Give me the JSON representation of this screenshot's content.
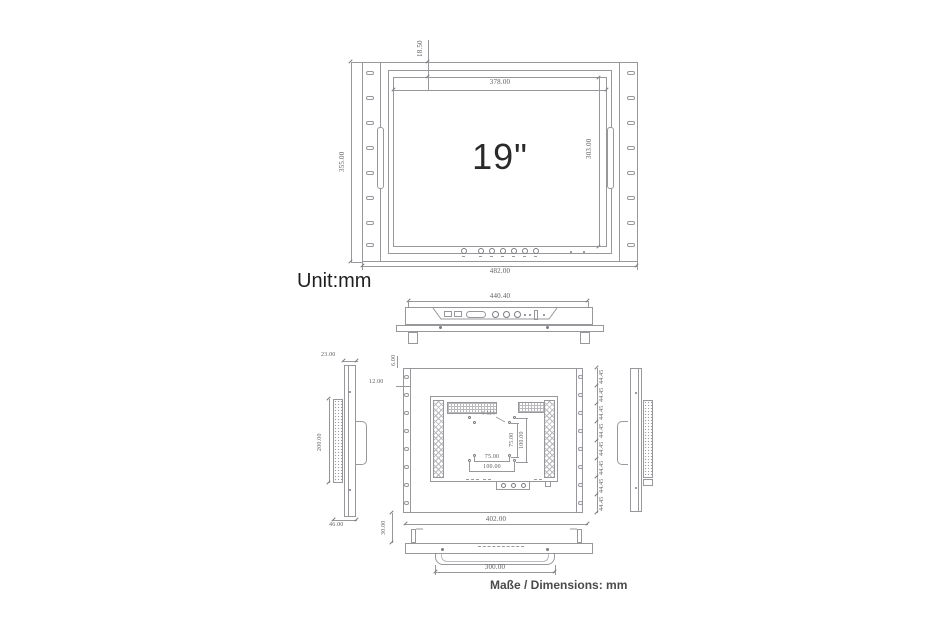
{
  "unit_label": "Unit:mm",
  "footer_note": "Maße / Dimensions: mm",
  "front_view": {
    "screen_label": "19\"",
    "dim_top_offset": "18.50",
    "dim_screen_width": "378.00",
    "dim_screen_height": "303.00",
    "dim_panel_height": "355.00",
    "dim_panel_width": "482.00"
  },
  "top_view": {
    "dim_width": "440.40"
  },
  "left_side_view": {
    "dim_top_depth": "23.00",
    "dim_vent_height": "200.00",
    "dim_bottom_depth": "46.00"
  },
  "rear_view": {
    "dim_top_inset": "6.00",
    "dim_side_inset": "12.00",
    "dim_bottom_gap": "30.00",
    "dim_width": "402.00",
    "vesa_callout": "4-M4",
    "dim_vesa_width_75": "75.00",
    "dim_vesa_width_100": "100.00",
    "dim_vesa_height_75": "75.00",
    "dim_vesa_height_100": "100.00",
    "rack_unit_spacing": "44.45"
  },
  "bottom_view": {
    "dim_recess_width": "300.00"
  }
}
